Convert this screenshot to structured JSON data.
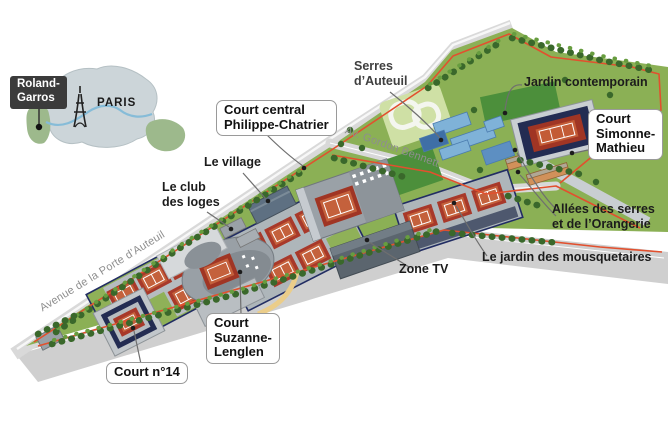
{
  "inset_map": {
    "marker_label": "Roland-\nGarros",
    "city_label": "PARIS"
  },
  "streets": {
    "porte_auteuil": "Avenue de la Porte d’Auteuil",
    "gordon_bennett": "Av. Gordon Bennett"
  },
  "venue_labels": {
    "chatrier": "Court central\nPhilippe-Chatrier",
    "simonne_mathieu": "Court\nSimonne-\nMathieu",
    "suzanne_lenglen": "Court\nSuzanne-\nLenglen",
    "court_14": "Court n°14"
  },
  "area_labels": {
    "serres": "Serres\nd’Auteuil",
    "jardin_contemporain": "Jardin contemporain",
    "village": "Le village",
    "club_loges": "Le club\ndes loges",
    "allees": "Allées des serres\net de l’Orangerie",
    "mousquetaires": "Le jardin des mousquetaires",
    "zone_tv": "Zone TV"
  },
  "colors": {
    "site_green": "#8bb055",
    "lawn_green": "#4c8f3b",
    "tree_green": "#3a682b",
    "clay_orange": "#c4613c",
    "clay_border_red": "#a03524",
    "court_navy": "#232c52",
    "greenhouse_blue": "#7fb2d8",
    "perimeter_red": "#e2502e",
    "road_grey": "#d6d6d6",
    "seine_blue": "#86bcd8"
  }
}
